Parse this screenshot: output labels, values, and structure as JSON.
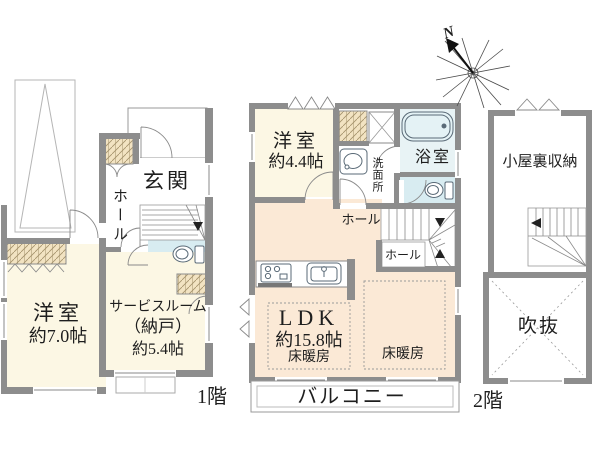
{
  "plan": {
    "floor1": {
      "label": "1階",
      "rooms": {
        "genkan": "玄関",
        "hall": "ホール",
        "western_name": "洋室",
        "western_size": "約7.0帖",
        "service_name": "サービスルーム",
        "service_name2": "（納戸）",
        "service_size": "約5.4帖"
      }
    },
    "floor2": {
      "label": "2階",
      "rooms": {
        "western_name": "洋室",
        "western_size": "約4.4帖",
        "washroom": "洗面所",
        "bathroom": "浴室",
        "hall_upper": "ホール",
        "hall_lower": "ホール",
        "ldk_name": "LDK",
        "ldk_size": "約15.8帖",
        "ldk_heating": "床暖房",
        "dining_heating": "床暖房",
        "balcony": "バルコニー"
      }
    },
    "attic": {
      "storage": "小屋裏収納",
      "void": "吹抜"
    },
    "compass_label": "N",
    "colors": {
      "wall": "#8d8d8d",
      "room_cream": "#fcf7e4",
      "ldk_peach": "#fbe9d6",
      "closet_tan": "#f2e3c2",
      "wet_blue": "#d8ecf1",
      "background": "#ffffff"
    }
  }
}
